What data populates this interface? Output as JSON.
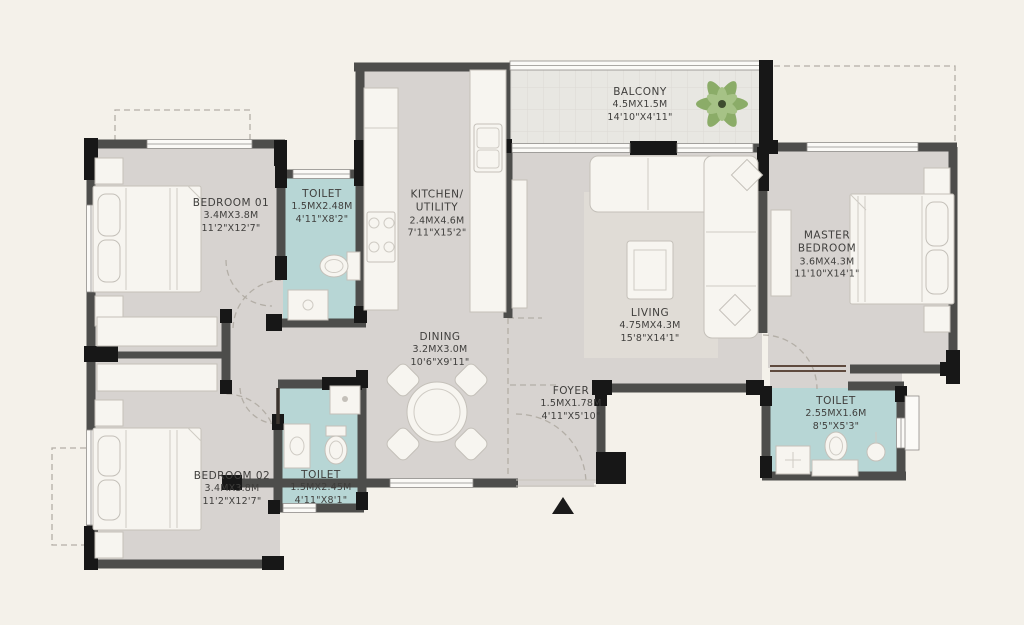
{
  "rooms": {
    "bedroom01": {
      "name": "BEDROOM 01",
      "metric": "3.4MX3.8M",
      "imperial": "11'2\"X12'7\""
    },
    "toilet01": {
      "name": "TOILET",
      "metric": "1.5MX2.48M",
      "imperial": "4'11\"X8'2\""
    },
    "kitchen_utility": {
      "name": "KITCHEN/ UTILITY",
      "metric": "2.4MX4.6M",
      "imperial": "7'11\"X15'2\""
    },
    "balcony": {
      "name": "BALCONY",
      "metric": "4.5MX1.5M",
      "imperial": "14'10\"X4'11\""
    },
    "living": {
      "name": "LIVING",
      "metric": "4.75MX4.3M",
      "imperial": "15'8\"X14'1\""
    },
    "master_bedroom": {
      "name": "MASTER BEDROOM",
      "metric": "3.6MX4.3M",
      "imperial": "11'10\"X14'1\""
    },
    "dining": {
      "name": "DINING",
      "metric": "3.2MX3.0M",
      "imperial": "10'6\"X9'11\""
    },
    "foyer": {
      "name": "FOYER",
      "metric": "1.5MX1.78M",
      "imperial": "4'11\"X5'10\""
    },
    "toilet_master": {
      "name": "TOILET",
      "metric": "2.55MX1.6M",
      "imperial": "8'5\"X5'3\""
    },
    "bedroom02": {
      "name": "BEDROOM 02",
      "metric": "3.4MX3.8M",
      "imperial": "11'2\"X12'7\""
    },
    "toilet02": {
      "name": "TOILET",
      "metric": "1.5MX2.45M",
      "imperial": "4'11\"X8'1\""
    }
  },
  "colors": {
    "background": "#f4f1ea",
    "floor": "#d7d3d0",
    "toilet_floor": "#b7d6d5",
    "balcony_floor": "#e8e7e2",
    "wall": "#4d4d4b",
    "wall_accent": "#171717",
    "furniture": "#f7f5f0",
    "text": "#3f3e3c",
    "plant": "#8bac68"
  }
}
